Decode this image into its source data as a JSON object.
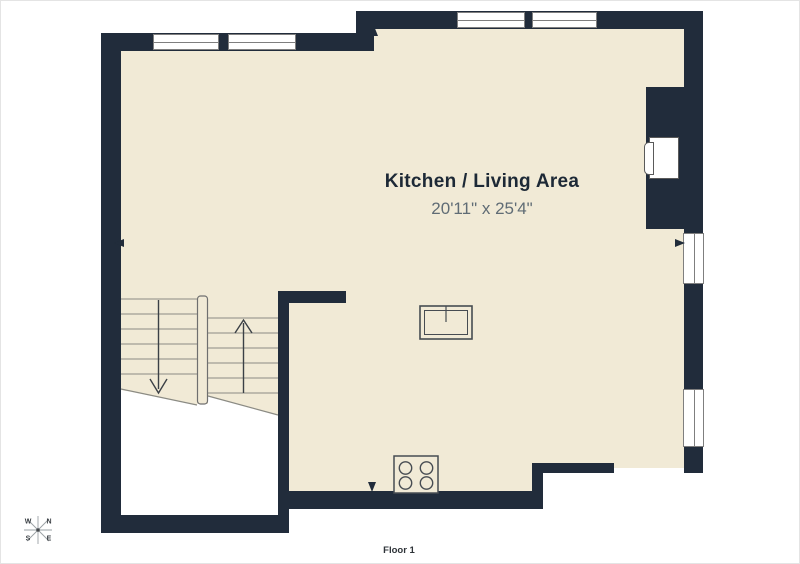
{
  "floorplan": {
    "room_label": "Kitchen / Living Area",
    "room_dimensions": "20'11\" x 25'4\"",
    "floor_label": "Floor 1",
    "compass": {
      "west": "W",
      "north": "N",
      "south": "S",
      "east": "E"
    },
    "colors": {
      "wall": "#212c3b",
      "floor": "#f1ead6",
      "window": "#ffffff",
      "line": "#8b8b84",
      "title_text": "#1d2936",
      "dims_text": "#606c75"
    },
    "fixtures": [
      "stairs-icon",
      "stair-up-arrow-icon",
      "stair-down-arrow-icon",
      "wood-stove-icon",
      "cooktop-icon",
      "fireplace-icon",
      "compass-rose-icon"
    ]
  }
}
